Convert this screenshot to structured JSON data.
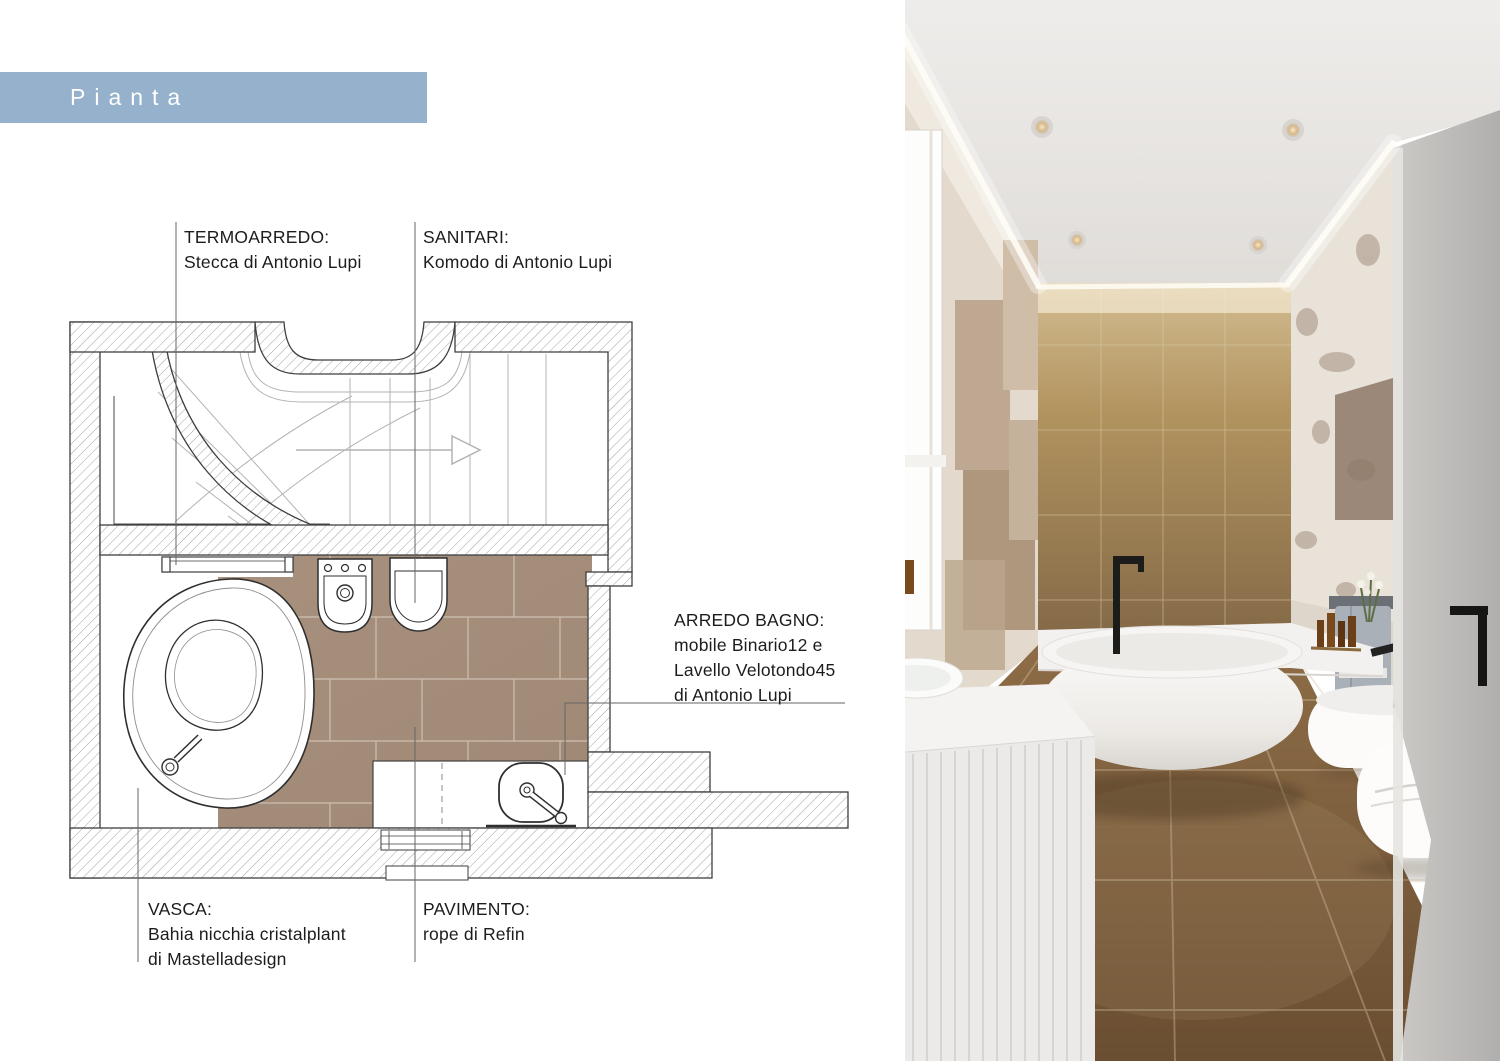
{
  "banner": {
    "label": "Pianta",
    "bg_color": "#95b1cc",
    "text_color": "#ffffff"
  },
  "plan": {
    "labels": {
      "termoarredo": {
        "title": "TERMOARREDO:",
        "body": "Stecca di Antonio Lupi"
      },
      "sanitari": {
        "title": "SANITARI:",
        "body": "Komodo di Antonio Lupi"
      },
      "arredo_bagno": {
        "title": "ARREDO BAGNO:",
        "body_lines": [
          "mobile Binario12 e",
          "Lavello Velotondo45",
          "di Antonio Lupi"
        ]
      },
      "vasca": {
        "title": "VASCA:",
        "body_lines": [
          "Bahia nicchia cristalplant",
          "di Mastelladesign"
        ]
      },
      "pavimento": {
        "title": "PAVIMENTO:",
        "body": "rope di Refin"
      }
    },
    "colors": {
      "tile": "#a6907d",
      "grout": "#d5c9bc",
      "wall_outline": "#3f3f3f",
      "hatch": "#a3a3a3",
      "leader": "#666666",
      "stair_lines": "#b3b3b3"
    }
  },
  "photo": {
    "description": "bathroom-render",
    "colors": {
      "ceiling": "#e9e7e4",
      "back_wall": "#b2945f",
      "floor": "#7c5e3d",
      "fixtures": "#f8f7f5",
      "door_wall": "#b9b7b5",
      "fittings": "#1c1c1a"
    }
  }
}
